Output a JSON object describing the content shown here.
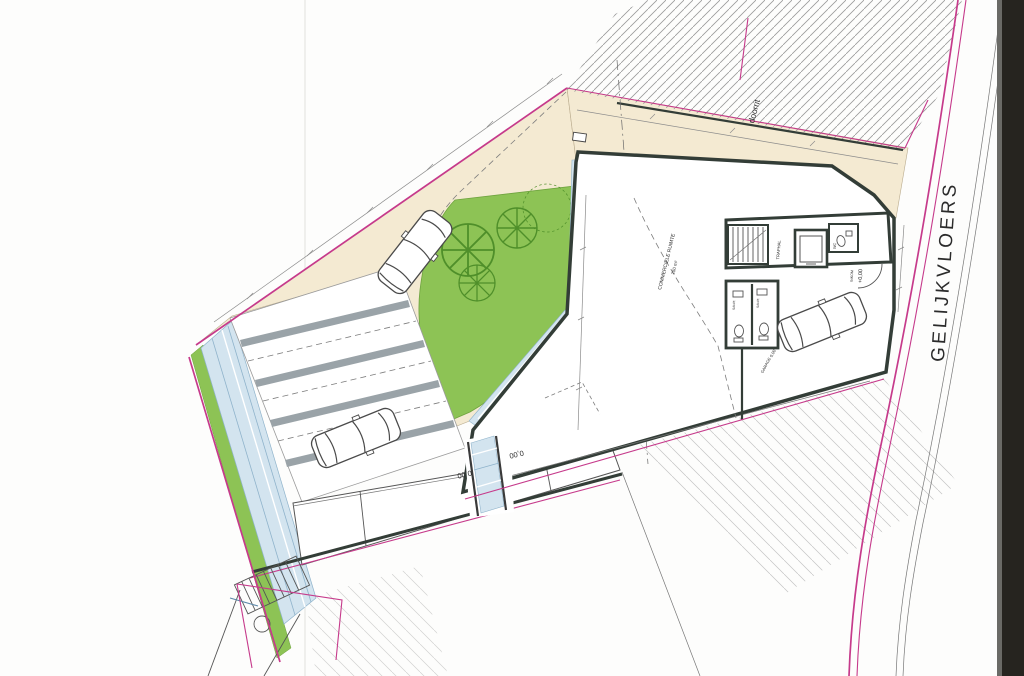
{
  "document": {
    "type": "architectural-site-plan",
    "floor": "ground floor"
  },
  "labels": {
    "floor_title": "GELIJKVLOERS",
    "driveway": "doorrit",
    "commercial_space": "COMMERCIËLE RUIMTE",
    "commercial_area": "250 m²",
    "stairwell": "TRAPHAL",
    "wc": "WC",
    "sanitary_1": "SANIT.",
    "sanitary_2": "SANIT.",
    "entrance": "INKOM",
    "entrance_level": "+0,00",
    "garage": "GARAGE",
    "garage_level": "0,00",
    "room_level_1": "0,00",
    "room_level_2": "0,00"
  },
  "colors": {
    "boundary": "#c63a8b",
    "garden": "#8dc355",
    "garden-line": "#4f8f2a",
    "paving": "#f4ead2",
    "walkway": "#d3e4ef",
    "walkway-line": "#8fb3cb",
    "wall": "#333d37",
    "ink": "#2b2b2b",
    "hatch": "#9a9a9a",
    "divider": "#9aa3a8",
    "dim": "#8b8b8b",
    "scan-edge": "#26241f"
  }
}
